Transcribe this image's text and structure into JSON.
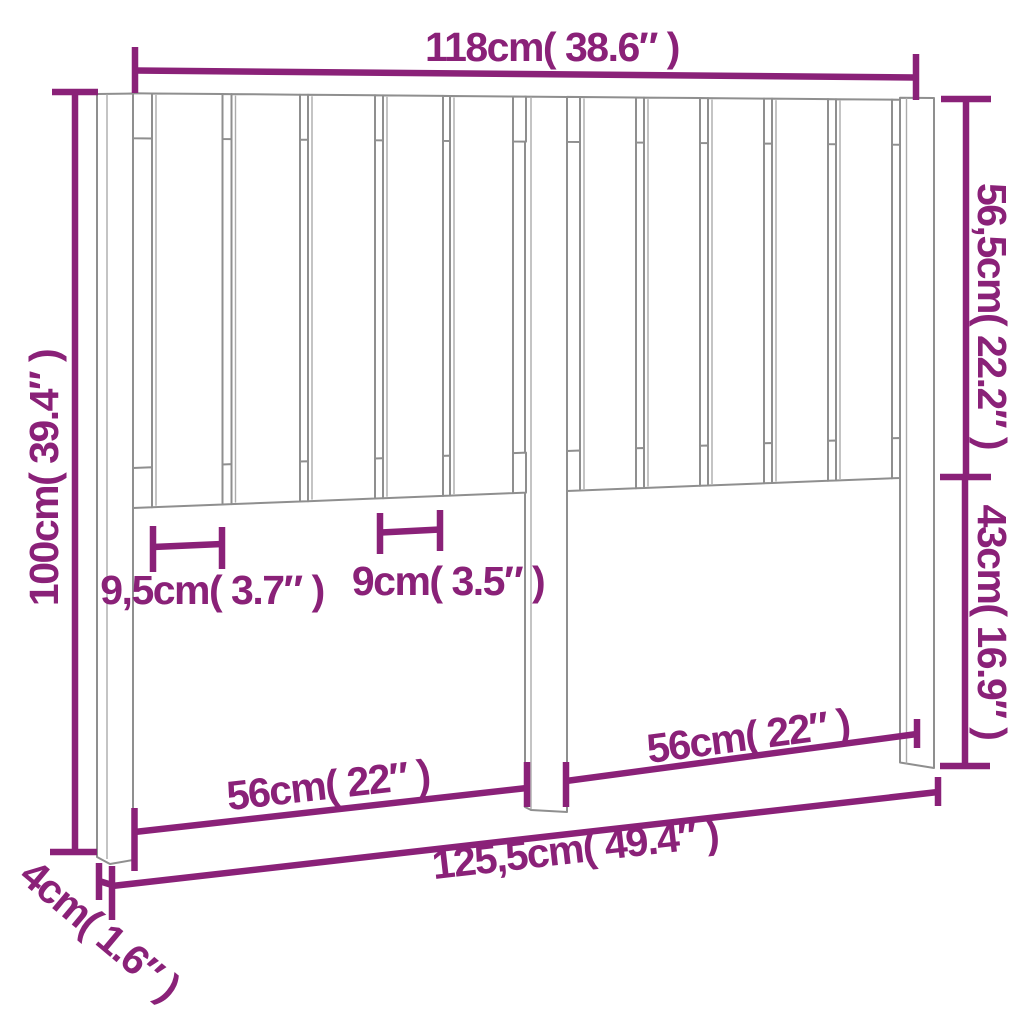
{
  "diagram": {
    "subject": "slatted-headboard-dimension-drawing",
    "accent_color": "#8a2178",
    "outline_color": "#8f8f8f",
    "dimensions": {
      "top_width": "118cm( 38.6″ )",
      "upper_section_height": "56,5cm( 22.2″ )",
      "lower_section_height": "43cm( 16.9″ )",
      "total_height": "100cm( 39.4″ )",
      "post_thickness": "4cm( 1.6″ )",
      "total_width": "125,5cm( 49.4″ )",
      "wide_slat_width": "9,5cm( 3.7″ )",
      "narrow_slat_width": "9cm( 3.5″ )",
      "left_section_width": "56cm( 22″ )",
      "right_section_width": "56cm( 22″ )"
    }
  }
}
